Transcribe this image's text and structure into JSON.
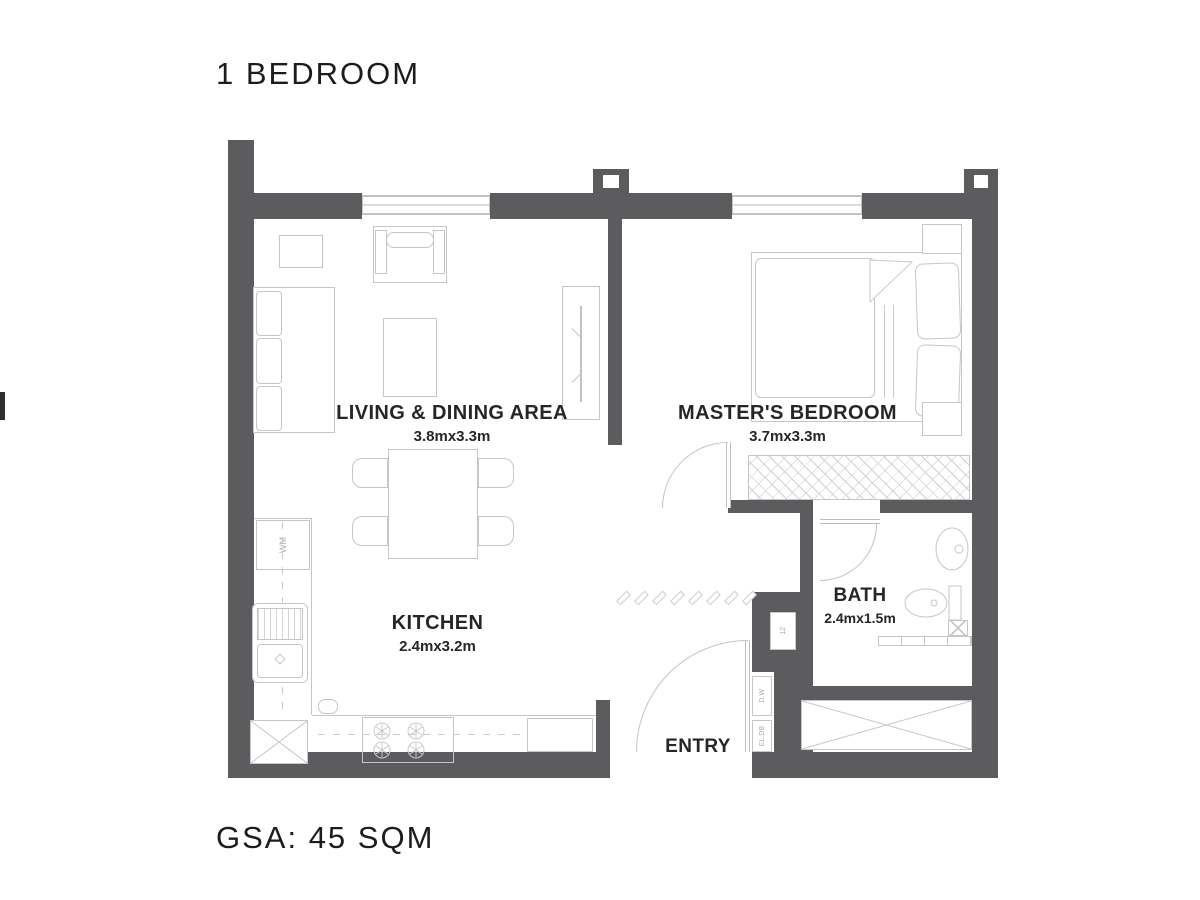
{
  "title": "1 BEDROOM",
  "area_label": "GSA: 45 SQM",
  "rooms": {
    "living": {
      "name": "LIVING & DINING AREA",
      "dims": "3.8mx3.3m"
    },
    "bedroom": {
      "name": "MASTER'S BEDROOM",
      "dims": "3.7mx3.3m"
    },
    "kitchen": {
      "name": "KITCHEN",
      "dims": "2.4mx3.2m"
    },
    "bath": {
      "name": "BATH",
      "dims": "2.4mx1.5m"
    },
    "entry": {
      "name": "ENTRY"
    }
  },
  "annotations": {
    "washing_machine": "WM",
    "duct_upper": "D.W",
    "duct_lower": "EL.DB",
    "shaft": "12"
  },
  "colors": {
    "wall": "#5c5c5e",
    "line": "#c6c6c9",
    "text": "#222222",
    "background": "#ffffff"
  }
}
